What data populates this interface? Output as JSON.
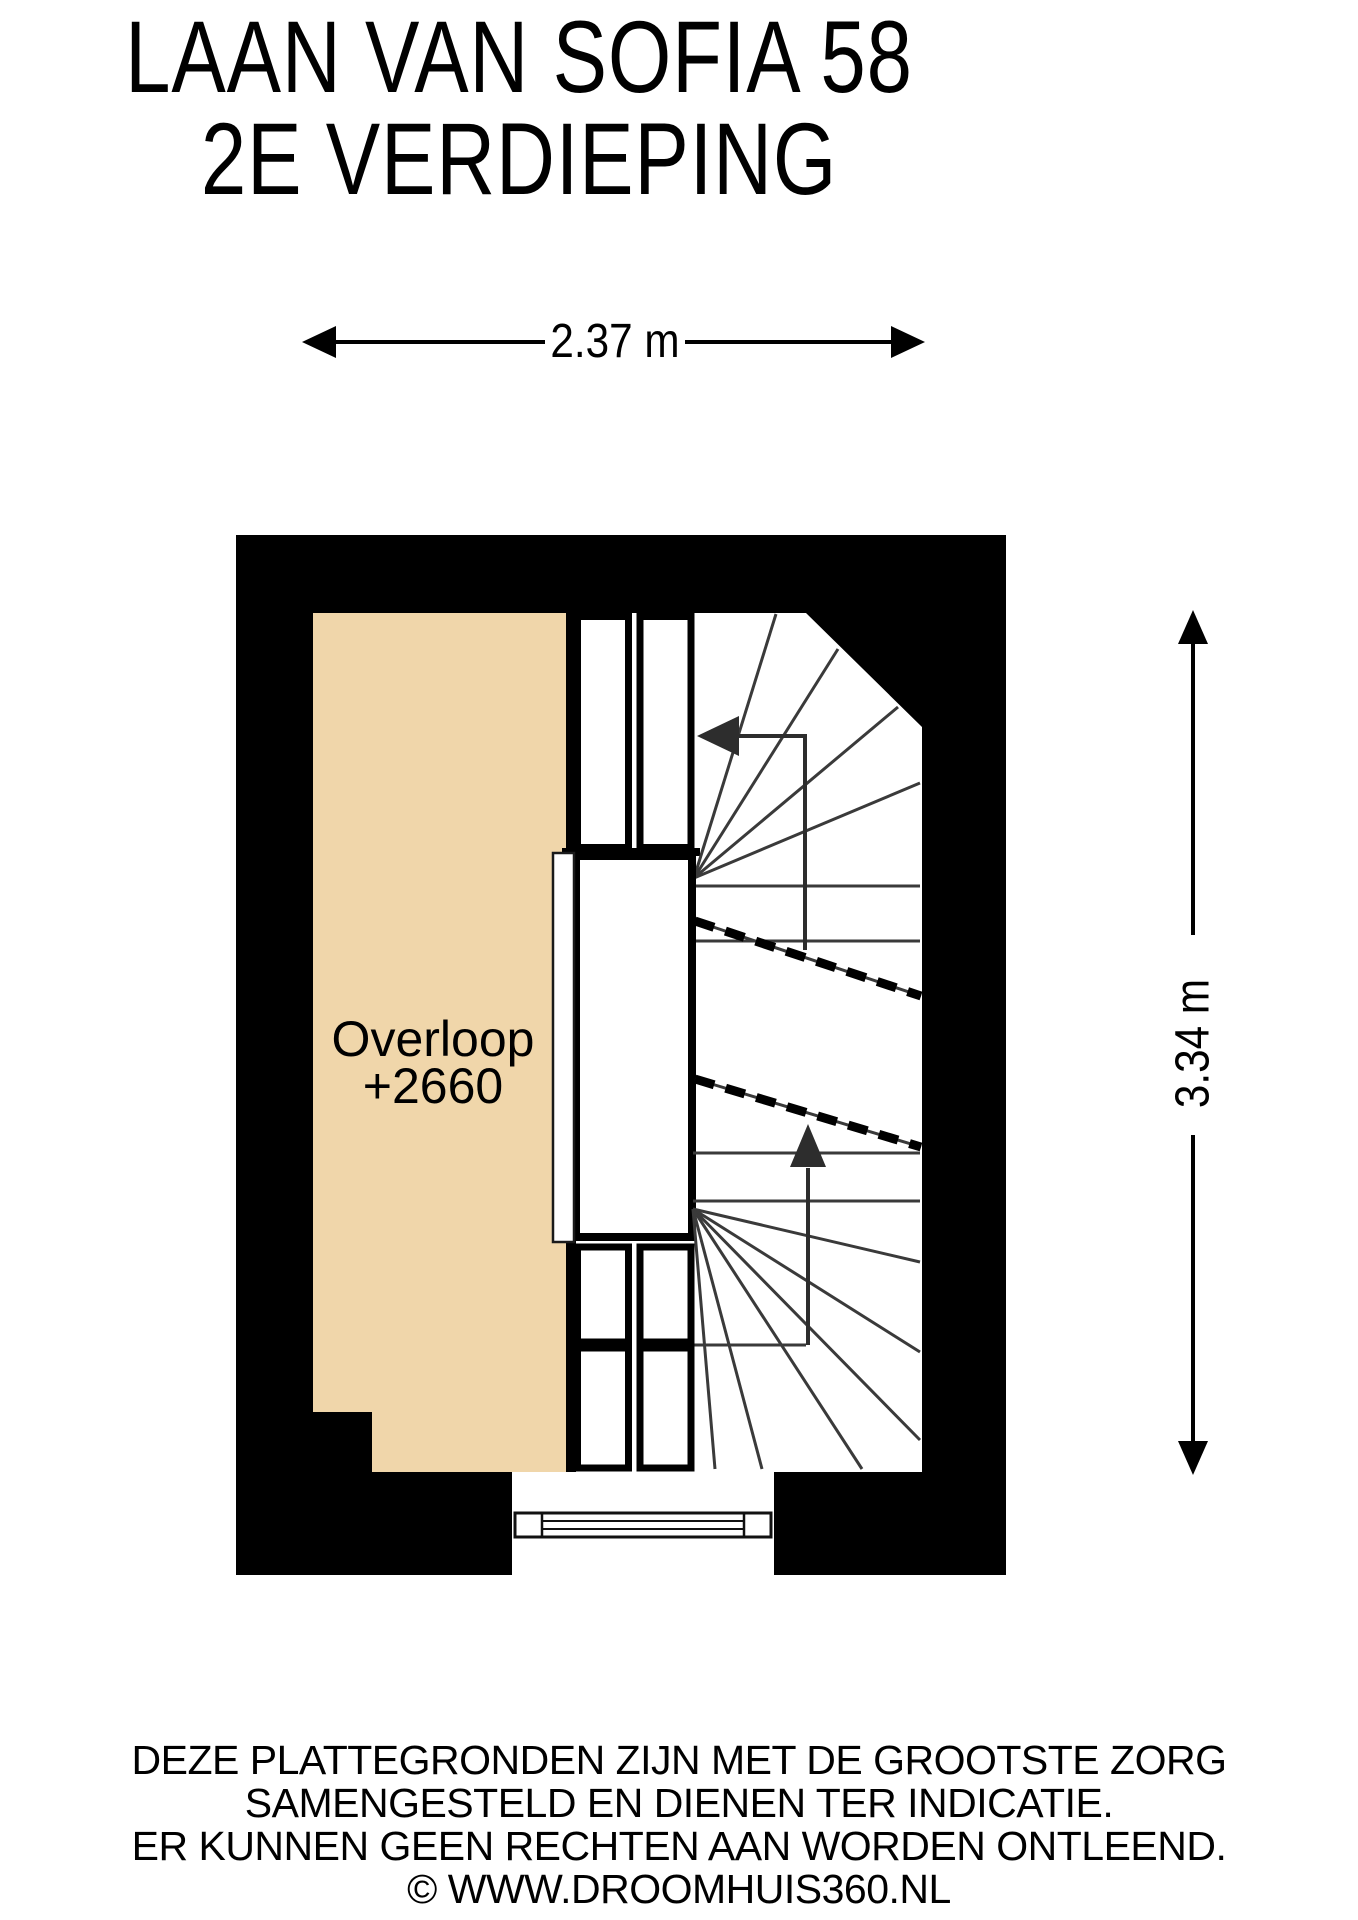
{
  "title": {
    "line1": "LAAN VAN SOFIA 58",
    "line2": "2E VERDIEPING"
  },
  "dimensions": {
    "width": "2.37 m",
    "height": "3.34 m"
  },
  "room": {
    "name": "Overloop",
    "elevation": "+2660"
  },
  "footer": {
    "line1": "DEZE PLATTEGRONDEN ZIJN MET DE GROOTSTE ZORG",
    "line2": "SAMENGESTELD EN DIENEN TER INDICATIE.",
    "line3": "ER KUNNEN GEEN RECHTEN AAN WORDEN ONTLEEND.",
    "line4": "© WWW.DROOMHUIS360.NL"
  },
  "colors": {
    "floor_fill": "#F0D6AA",
    "wall": "#000000",
    "stair_line": "#3A3A3A"
  }
}
